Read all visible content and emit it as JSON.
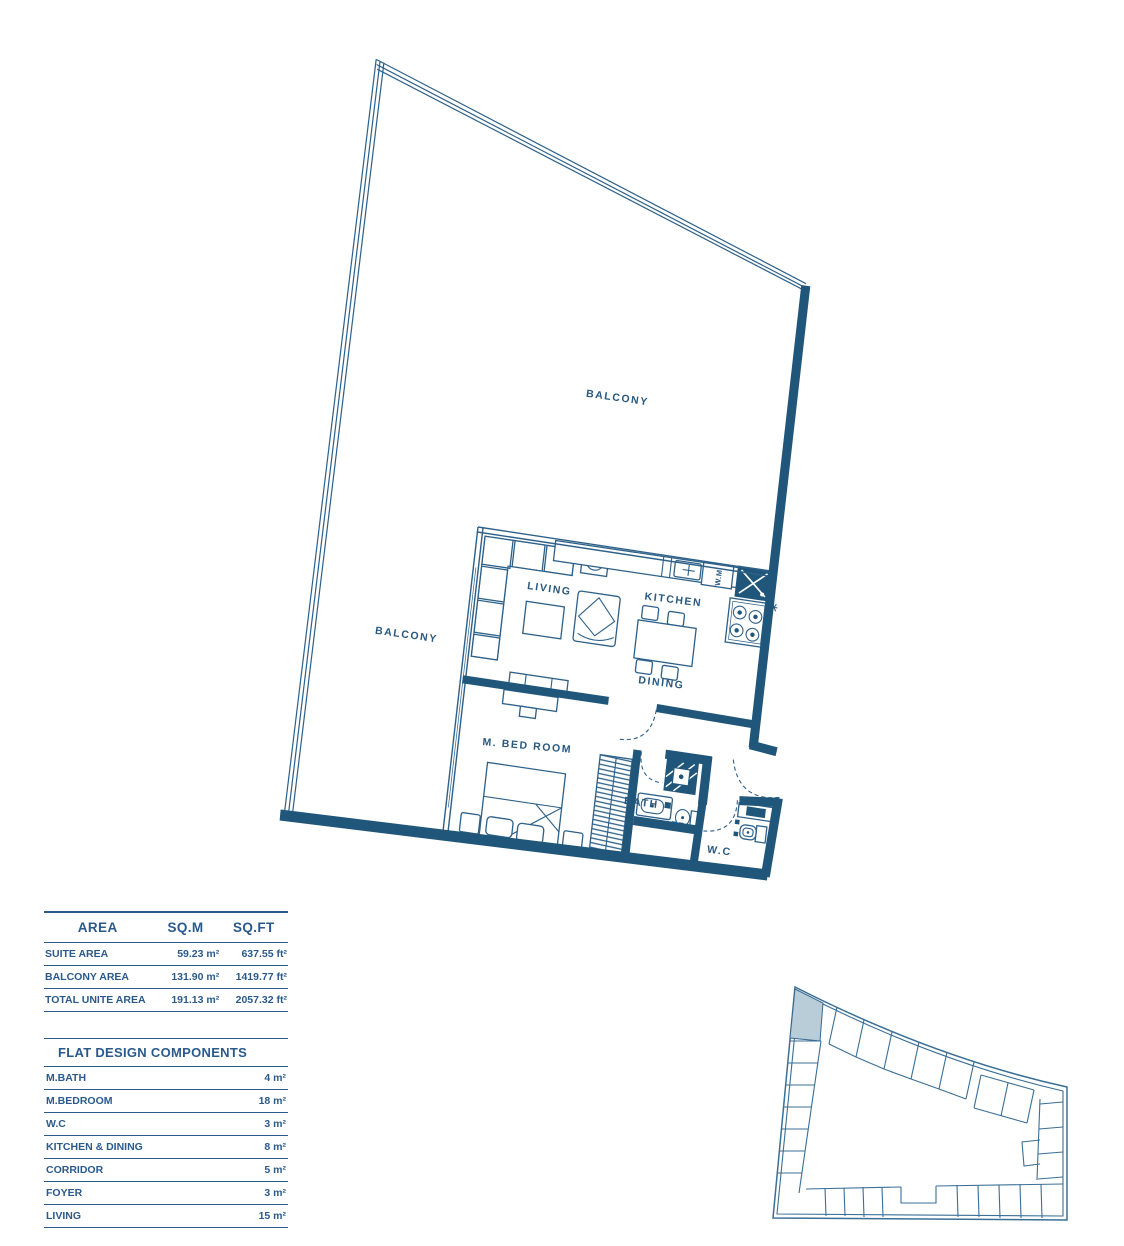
{
  "plan": {
    "labels": {
      "balcony_top": "BALCONY",
      "balcony_left": "BALCONY",
      "living": "LIVING",
      "kitchen": "KITCHEN",
      "dining": "DINING",
      "m_bedroom": "M. BED ROOM",
      "bath": "BATH",
      "wc": "W.C",
      "wm": "W.M"
    },
    "colors": {
      "wall": "#21567b",
      "line": "#2e6189",
      "label": "#29587f",
      "table_text": "#2a5a8c",
      "keyplan_line": "#3a6f96",
      "highlight_unit": "#b9cdd9"
    }
  },
  "area_table": {
    "headers": [
      "AREA",
      "SQ.M",
      "SQ.FT"
    ],
    "rows": [
      {
        "label": "SUITE AREA",
        "sqm": "59.23 m²",
        "sqft": "637.55 ft²"
      },
      {
        "label": "BALCONY AREA",
        "sqm": "131.90 m²",
        "sqft": "1419.77 ft²"
      },
      {
        "label": "TOTAL UNITE AREA",
        "sqm": "191.13 m²",
        "sqft": "2057.32 ft²"
      }
    ]
  },
  "components_table": {
    "title": "FLAT DESIGN COMPONENTS",
    "rows": [
      {
        "label": "M.BATH",
        "value": "4 m²"
      },
      {
        "label": "M.BEDROOM",
        "value": "18 m²"
      },
      {
        "label": "W.C",
        "value": "3 m²"
      },
      {
        "label": "KITCHEN & DINING",
        "value": "8 m²"
      },
      {
        "label": "CORRIDOR",
        "value": "5 m²"
      },
      {
        "label": "FOYER",
        "value": "3 m²"
      },
      {
        "label": "LIVING",
        "value": "15 m²"
      }
    ]
  }
}
